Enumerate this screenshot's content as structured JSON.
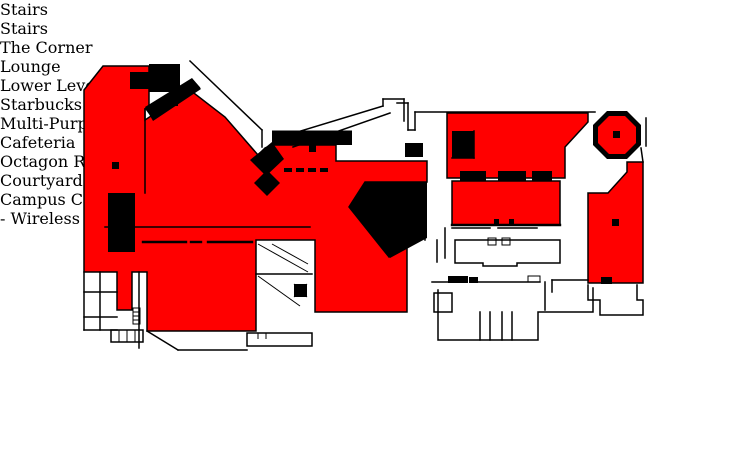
{
  "colors": {
    "wireless_area": "#FF0000",
    "walls": "#000000",
    "background": "#FFFFFF",
    "title_text": "#FF0000",
    "label_text": "#000000"
  },
  "title": {
    "line1": "Campus Center First Floor",
    "line2": "Wireless Coverage"
  },
  "legend": {
    "label": "- Wireless Area",
    "swatch_color": "#FF0000",
    "swatch_style": "background:#FF0000"
  },
  "rooms": {
    "lounge": "Lounge",
    "cafeteria": "Cafeteria",
    "starbucks": "Starbucks",
    "multi_purpose": {
      "line1": "Multi-Purpose",
      "line2": "Room"
    },
    "lower_level": {
      "line1": "Lower",
      "line2": "Level"
    }
  },
  "callouts": {
    "stairs_top": "Stairs",
    "stairs_middle": "Stairs",
    "the_corner": {
      "line1": "The",
      "line2": "Corner"
    },
    "octagon_room": {
      "line1": "Octagon",
      "line2": "Room"
    },
    "courtyard_cafe": {
      "line1": "Courtyard",
      "line2": "Cafe"
    }
  }
}
